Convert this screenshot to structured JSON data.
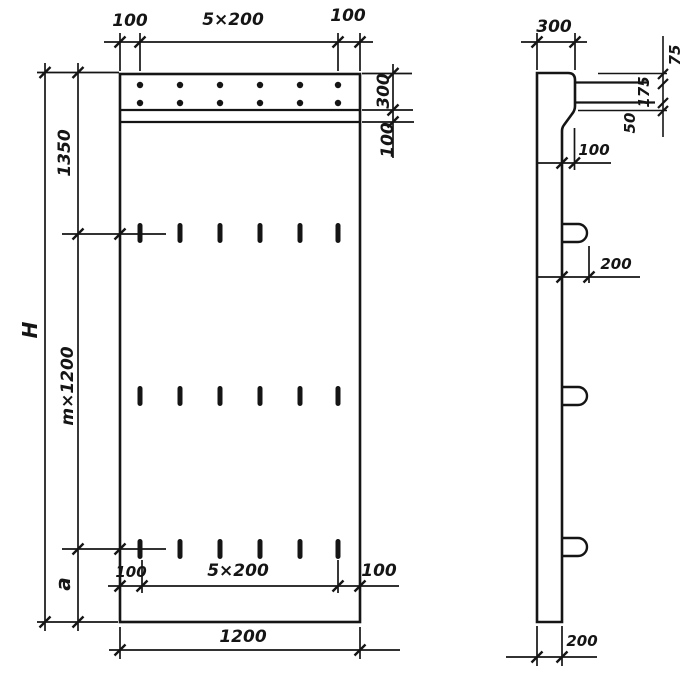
{
  "colors": {
    "ink": "#151515",
    "paper": "#ffffff"
  },
  "front": {
    "top_dim": {
      "left": "100",
      "middle": "5×200",
      "right": "100"
    },
    "strip_dim": {
      "strip_height": "300",
      "band_height": "100"
    },
    "left_dim": {
      "total_height": "H",
      "top_offset": "1350",
      "module": "m×1200",
      "bottom_offset": "a"
    },
    "bottom_inner_dim": {
      "left": "100",
      "middle": "5×200",
      "right": "100"
    },
    "bottom_dim": {
      "overall_width": "1200"
    }
  },
  "side": {
    "top_dim": {
      "top_width": "300"
    },
    "right_dim": {
      "top": "75",
      "middle": "175",
      "bottom": "50"
    },
    "step_dim": {
      "offset": "100"
    },
    "loop_dim": {
      "protrusion": "200"
    },
    "bottom_dim": {
      "wall_thickness": "200"
    }
  }
}
